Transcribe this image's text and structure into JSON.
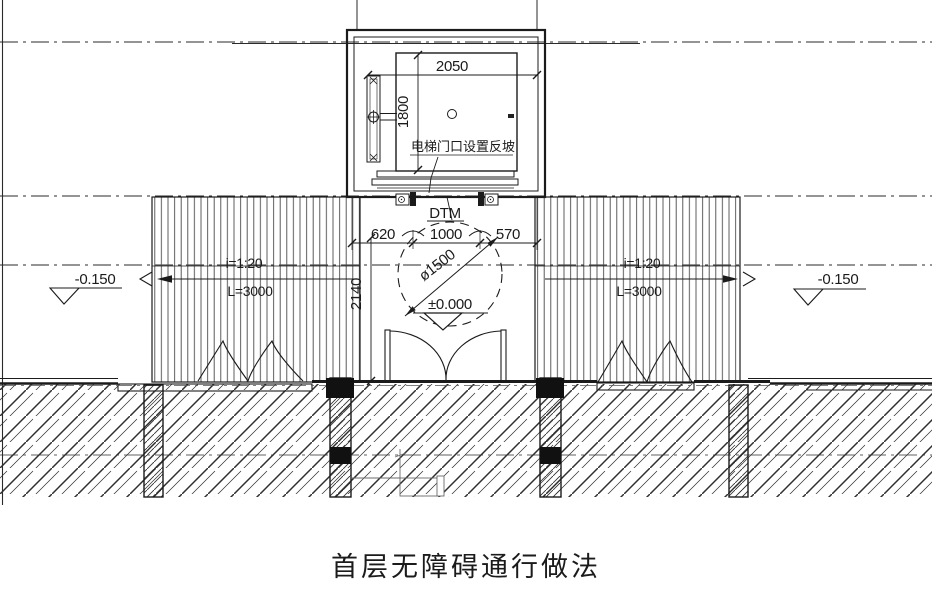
{
  "drawing": {
    "title": "首层无障碍通行做法",
    "elevator": {
      "width_dim": "2050",
      "depth_dim": "1800",
      "door_note": "电梯门口设置反坡",
      "model_label": "DTM"
    },
    "landing": {
      "dim_left": "620",
      "dim_door": "1000",
      "dim_right": "570",
      "dim_depth": "2140",
      "turning_circle_dim": "ø1500",
      "datum_level": "±0.000"
    },
    "left_side": {
      "level": "-0.150",
      "ramp_slope": "i=1:20",
      "ramp_length": "L=3000"
    },
    "right_side": {
      "level": "-0.150",
      "ramp_slope": "i=1:20",
      "ramp_length": "L=3000"
    },
    "colors": {
      "line": "#1b1b1b",
      "hatch": "#3a3a3a",
      "background": "#ffffff"
    }
  }
}
